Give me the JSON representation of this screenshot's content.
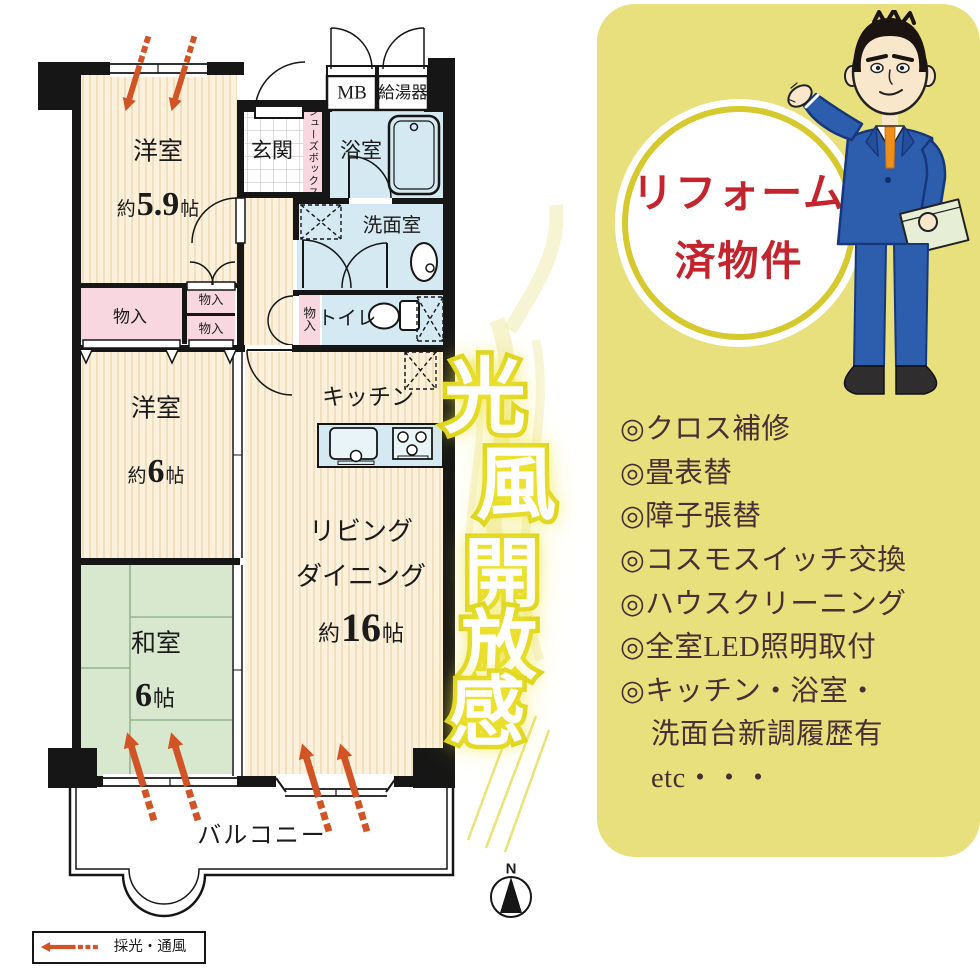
{
  "plan": {
    "rooms": {
      "bedroom59": {
        "name": "洋室",
        "about": "約",
        "num": "5.9",
        "unit": "帖"
      },
      "bedroom6": {
        "name": "洋室",
        "about": "約",
        "num": "6",
        "unit": "帖"
      },
      "washitsu": {
        "name": "和室",
        "num": "6",
        "unit": "帖"
      },
      "living": {
        "line1": "リビング",
        "line2": "ダイニング",
        "about": "約",
        "num": "16",
        "unit": "帖"
      },
      "kitchen": {
        "name": "キッチン"
      },
      "entrance": {
        "name": "玄関"
      },
      "shoes_box": {
        "name": "シューズボックス"
      },
      "meter_box": {
        "name": "MB"
      },
      "water_heater": {
        "name": "給湯器"
      },
      "bath": {
        "name": "浴室"
      },
      "washroom": {
        "name": "洗面室"
      },
      "toilet": {
        "name": "トイレ"
      },
      "closet": {
        "name": "物入"
      },
      "closet_small_1": {
        "name": "物入"
      },
      "closet_small_2": {
        "name": "物入"
      },
      "closet_hall": {
        "name": "物入"
      },
      "balcony": {
        "name": "バルコニー"
      }
    },
    "legend": {
      "label": "採光・通風"
    },
    "compass": {
      "north": "N"
    },
    "catchphrase": {
      "chars": [
        "光",
        "風",
        "開",
        "放",
        "感"
      ]
    }
  },
  "panel": {
    "badge": {
      "line1": "リフォーム",
      "line2": "済物件"
    },
    "items": [
      "◎クロス補修",
      "◎畳表替",
      "◎障子張替",
      "◎コスモスイッチ交換",
      "◎ハウスクリーニング",
      "◎全室LED照明取付",
      "◎キッチン・浴室・",
      "洗面台新調履歴有",
      "etc・・・"
    ]
  },
  "colors": {
    "wall": "#161616",
    "room_cream": "#fcf1dc",
    "room_pink": "#f8d7e1",
    "room_blue": "#d5e9f2",
    "room_green": "#d8e8cf",
    "arrow_orange": "#d25426",
    "panel_bg": "#e8e07c",
    "badge_ring": "#d5c92e",
    "badge_text": "#c3242e",
    "list_text": "#4a2e34",
    "glow_yellow": "#dcd319"
  }
}
